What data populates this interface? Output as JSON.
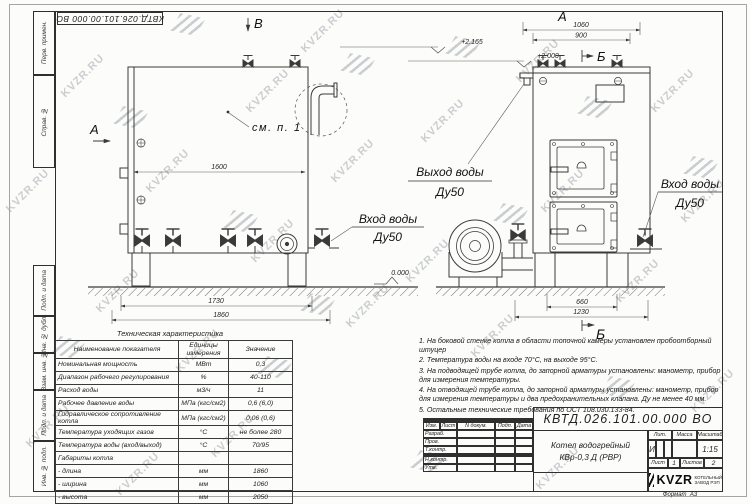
{
  "watermark": {
    "text": "KVZR.RU"
  },
  "doc_number": "КВТД.026.101.00.000 ВО",
  "frame": {
    "left_strip": [
      "Перв. примен.",
      "Справ. №",
      "Подп. и дата",
      "Инв. № дубл.",
      "Взам. инв. №",
      "Подп. и дата",
      "Инв. № подл."
    ]
  },
  "markers": {
    "front_section_a": "А",
    "front_section_b": "В",
    "side_label_a": "А",
    "side_section_b_top": "Б",
    "side_section_b_bottom": "Б",
    "detail_callout": "см. п. 1"
  },
  "dims": {
    "front_inner_width": "1600",
    "front_1730": "1730",
    "front_1860": "1860",
    "elev_top": "+2.165",
    "elev_mid": "+2.000",
    "elev_zero": "0.000",
    "side_1060": "1060",
    "side_900": "900",
    "side_660": "660",
    "side_1230": "1230"
  },
  "labels": {
    "front_inlet_line1": "Вход воды",
    "front_inlet_line2": "Ду50",
    "side_outlet_line1": "Выход воды",
    "side_outlet_line2": "Ду50",
    "side_inlet_line1": "Вход воды",
    "side_inlet_line2": "Ду50"
  },
  "spec_table": {
    "title": "Техническая характеристика",
    "headers": [
      "Наименование показателя",
      "Единицы измерения",
      "Значение"
    ],
    "rows": [
      [
        "Номинальная мощность",
        "МВт",
        "0,3"
      ],
      [
        "Диапазон рабочего регулирования",
        "%",
        "40-110"
      ],
      [
        "Расход воды",
        "м3/ч",
        "11"
      ],
      [
        "Рабочее давление воды",
        "МПа (кгс/см2)",
        "0,6 (6,0)"
      ],
      [
        "Гидравлическое сопротивление котла",
        "МПа (кгс/см2)",
        "0,06 (0,6)"
      ],
      [
        "Температура уходящих газов",
        "°С",
        "не более 280"
      ],
      [
        "Температура воды (вход/выход)",
        "°С",
        "70/95"
      ],
      [
        "Габариты котла",
        "",
        ""
      ],
      [
        "    - длина",
        "мм",
        "1860"
      ],
      [
        "    - ширина",
        "мм",
        "1060"
      ],
      [
        "    - высота",
        "мм",
        "2050"
      ]
    ]
  },
  "notes": [
    "1.  На боковой стенке котла в области топочной камеры установлен пробоотборный штуцер",
    "2.  Температура воды на входе  70°С,  на выходе  95°С.",
    "3.  На подводящей трубе котла, до запорной арматуры установлены:  манометр,  прибор для измерения температуры.",
    "4.  На отводящей трубе котла, до запорной арматуры установлены:  манометр,  прибор для измерения температуры и два предохранительных клапана.  Ду не менее  40 мм.",
    "5.  Остальные технические требования по ОСТ  108.030.133-84."
  ],
  "title_block": {
    "product_line1": "Котел водогрейный",
    "product_line2": "КВр-0,3  Д  (РВР)",
    "hdr_izm": "Изм.",
    "hdr_list": "Лист",
    "hdr_doc": "N докум.",
    "hdr_podp": "Подп.",
    "hdr_data": "Дата",
    "row_razrab": "Разраб.",
    "row_prov": "Пров.",
    "row_tkontr": "Т.контр.",
    "row_nkontr": "Н.контр.",
    "row_utv": "Утв.",
    "lit_label": "Лит.",
    "lit_value": "И",
    "mass_label": "Масса",
    "scale_label": "Масштаб",
    "scale_value": "1:15",
    "sheet_label": "Лист",
    "sheet_value": "1",
    "sheets_label": "Листов",
    "sheets_value": "2",
    "logo_word": "KVZR",
    "logo_sub1": "КОТЕЛЬНЫЙ",
    "logo_sub2": "ЗАВОД РЭП",
    "format_label": "Формат",
    "format_value": "А3"
  }
}
